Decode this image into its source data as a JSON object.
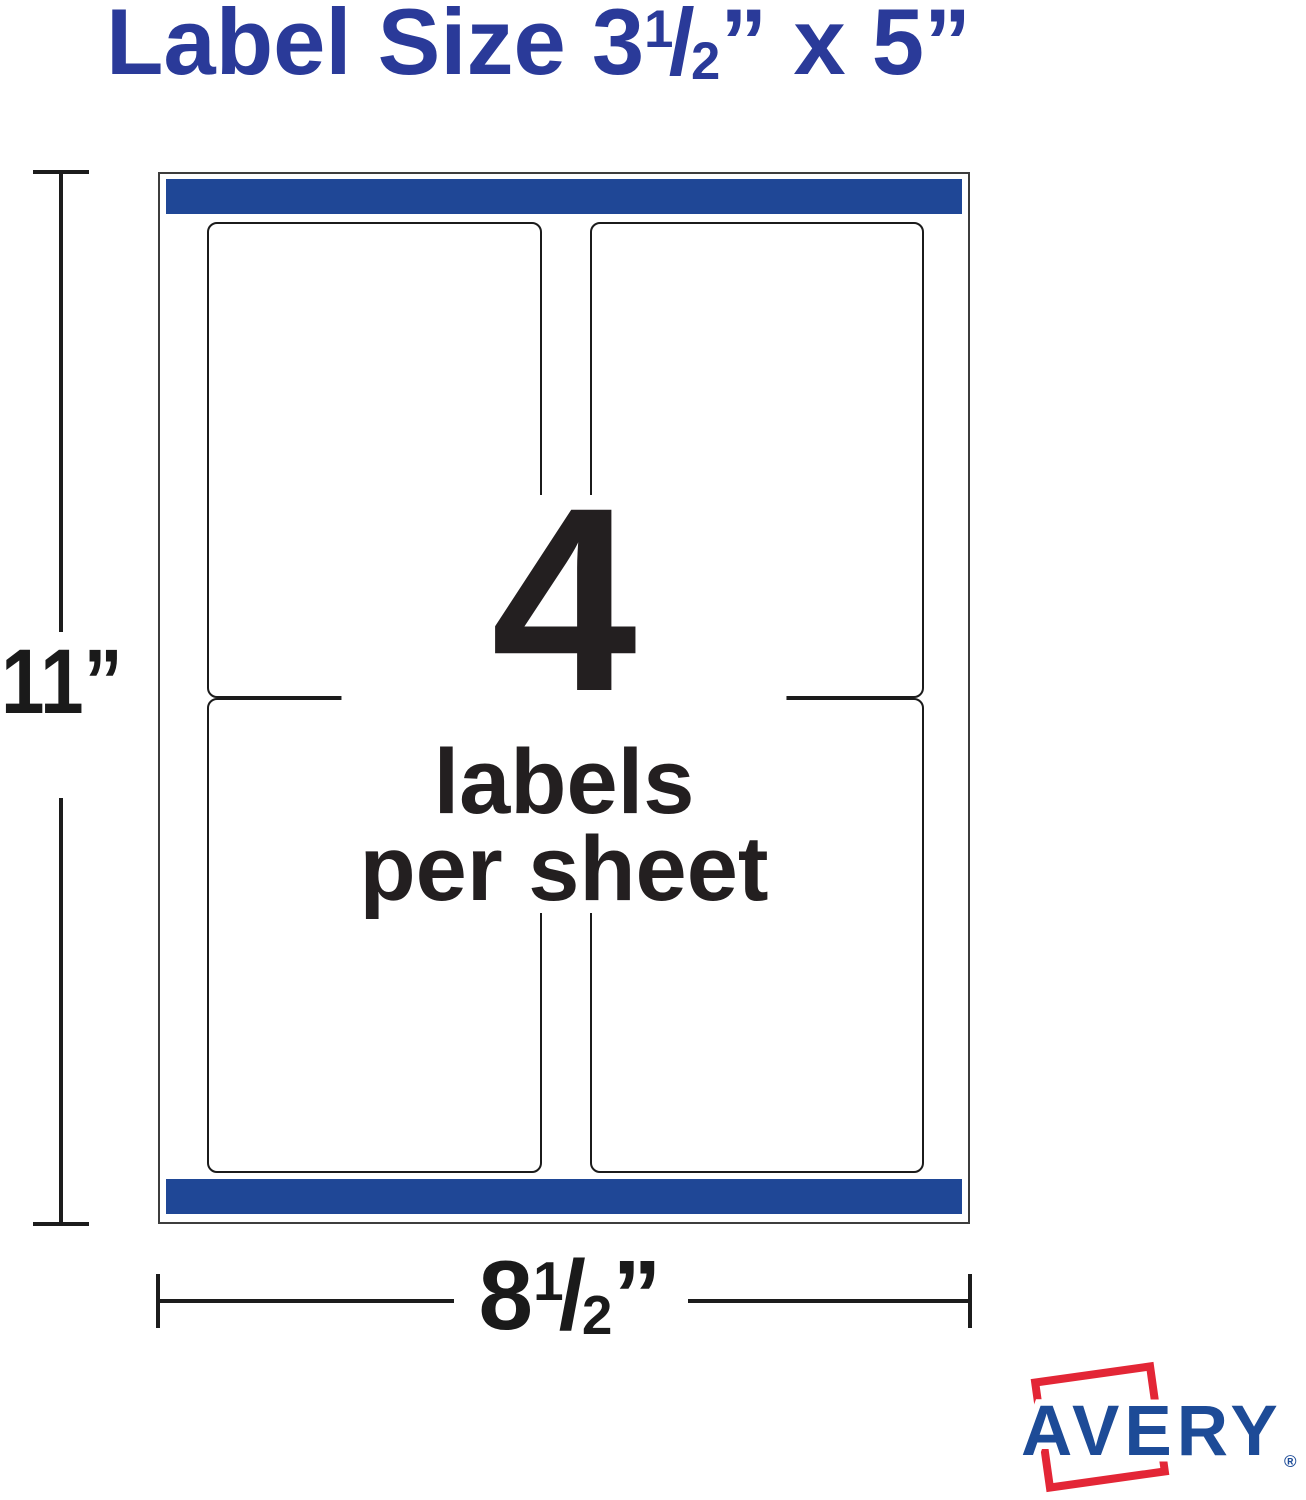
{
  "title": {
    "pre": "Label Size 3",
    "frac_num": "1",
    "frac_slash": "/",
    "frac_den": "2",
    "post": "” x 5”"
  },
  "sheet": {
    "count": "4",
    "caption_line1": "labels",
    "caption_line2": "per sheet"
  },
  "dimensions": {
    "height": "11”",
    "width_pre": "8",
    "width_frac_num": "1",
    "width_frac_slash": "/",
    "width_frac_den": "2",
    "width_post": "”"
  },
  "brand": {
    "name": "AVERY",
    "registered": "®"
  },
  "colors": {
    "title_blue": "#2a3a99",
    "band_blue": "#1f4796",
    "avery_blue": "#1d4b97",
    "avery_red": "#e32636",
    "ink": "#231f20"
  }
}
